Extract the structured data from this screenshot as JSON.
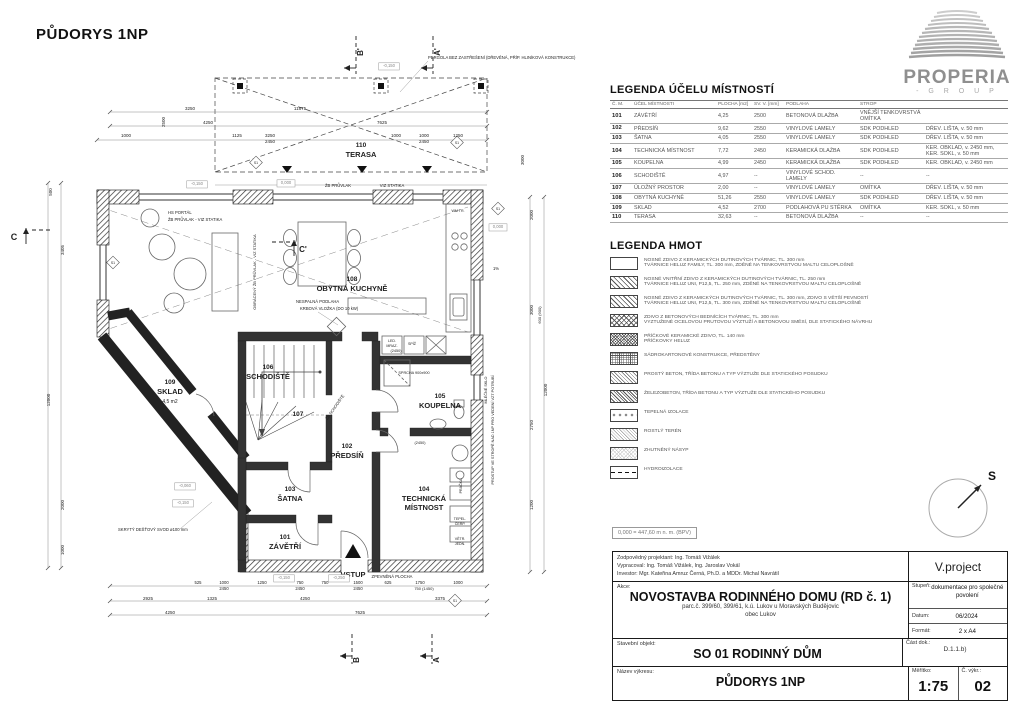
{
  "plan": {
    "title": "PŮDORYS 1NP",
    "texts": [
      {
        "t": "110",
        "x": 361,
        "y": 147,
        "s": 6.5,
        "b": 1,
        "n": "room-number-110"
      },
      {
        "t": "TERASA",
        "x": 361,
        "y": 157,
        "s": 7.5,
        "b": 1,
        "n": "room-label-terasa"
      },
      {
        "t": "108",
        "x": 352,
        "y": 281,
        "s": 6.5,
        "b": 1,
        "n": "room-number-108"
      },
      {
        "t": "OBYTNÁ KUCHYNĚ",
        "x": 352,
        "y": 291,
        "s": 7.5,
        "b": 1,
        "n": "room-label-obytna-kuchyne"
      },
      {
        "t": "109",
        "x": 170,
        "y": 384,
        "s": 6.5,
        "b": 1,
        "n": "room-number-109"
      },
      {
        "t": "SKLAD",
        "x": 170,
        "y": 394,
        "s": 7.5,
        "b": 1,
        "n": "room-label-sklad"
      },
      {
        "t": "4,5 m2",
        "x": 170,
        "y": 403,
        "s": 5,
        "n": "room-area-sklad"
      },
      {
        "t": "106",
        "x": 268,
        "y": 369,
        "s": 6.5,
        "b": 1,
        "n": "room-number-106"
      },
      {
        "t": "SCHODIŠTĚ",
        "x": 268,
        "y": 379,
        "s": 7.5,
        "b": 1,
        "n": "room-label-schodiste"
      },
      {
        "t": "107",
        "x": 298,
        "y": 416,
        "s": 6.5,
        "b": 1,
        "n": "room-number-107"
      },
      {
        "t": "102",
        "x": 347,
        "y": 448,
        "s": 6.5,
        "b": 1,
        "n": "room-number-102"
      },
      {
        "t": "PŘEDSÍŇ",
        "x": 347,
        "y": 458,
        "s": 7.5,
        "b": 1,
        "n": "room-label-predsin"
      },
      {
        "t": "103",
        "x": 290,
        "y": 491,
        "s": 6.5,
        "b": 1,
        "n": "room-number-103"
      },
      {
        "t": "ŠATNA",
        "x": 290,
        "y": 501,
        "s": 7.5,
        "b": 1,
        "n": "room-label-satna"
      },
      {
        "t": "101",
        "x": 285,
        "y": 539,
        "s": 6.5,
        "b": 1,
        "n": "room-number-101"
      },
      {
        "t": "ZÁVĚTŘÍ",
        "x": 285,
        "y": 549,
        "s": 7.5,
        "b": 1,
        "n": "room-label-zavetri"
      },
      {
        "t": "VSTUP",
        "x": 353,
        "y": 577,
        "s": 7.5,
        "b": 1,
        "n": "entrance-label"
      },
      {
        "t": "104",
        "x": 424,
        "y": 491,
        "s": 6.5,
        "b": 1,
        "n": "room-number-104"
      },
      {
        "t": "TECHNICKÁ",
        "x": 424,
        "y": 501,
        "s": 7.5,
        "b": 1,
        "n": "room-label-technicka"
      },
      {
        "t": "MÍSTNOST",
        "x": 424,
        "y": 510,
        "s": 7.5,
        "b": 1,
        "n": "room-label-mistnost"
      },
      {
        "t": "105",
        "x": 440,
        "y": 398,
        "s": 6.5,
        "b": 1,
        "n": "room-number-105"
      },
      {
        "t": "KOUPELNA",
        "x": 440,
        "y": 408,
        "s": 7.5,
        "b": 1,
        "n": "room-label-koupelna"
      },
      {
        "t": "PERGOLA BEZ ZASTŘEŠENÍ (DŘEVĚNÁ, PŘÍP. HLINÍKOVÁ KONSTRUKCE)",
        "x": 428,
        "y": 59,
        "s": 4.2,
        "a": "start",
        "n": "pergola-note"
      },
      {
        "t": "HS PORTÁL",
        "x": 168,
        "y": 214,
        "s": 4.2,
        "a": "start",
        "n": "note-hs-portal"
      },
      {
        "t": "ŽB PRŮVLAK - VIZ STATIKA",
        "x": 168,
        "y": 221,
        "s": 4.2,
        "a": "start",
        "n": "note-pruvlak"
      },
      {
        "t": "ŽB PRŮVLAK",
        "x": 338,
        "y": 187,
        "s": 4.2,
        "n": "note-pruvlak-2"
      },
      {
        "t": "VIZ STATIKA",
        "x": 392,
        "y": 187,
        "s": 4.2,
        "n": "note-viz-statika"
      },
      {
        "t": "NESPALNÁ PODLAHA",
        "x": 296,
        "y": 303,
        "s": 4.2,
        "a": "start",
        "n": "note-krb-1"
      },
      {
        "t": "KRBOVÁ VLOŽKA (DO 10 kW)",
        "x": 300,
        "y": 310,
        "s": 4.2,
        "a": "start",
        "n": "note-krb-2"
      },
      {
        "t": "OBRÁCENÝ ŽB PRŮVLAK - VIZ STATIKA",
        "x": 256,
        "y": 272,
        "s": 4,
        "r": -90,
        "n": "note-obraceny-pruvlak"
      },
      {
        "t": "SPRCHA 900x900",
        "x": 414,
        "y": 374,
        "s": 3.8,
        "n": "note-sprcha"
      },
      {
        "t": "(2450)",
        "x": 396,
        "y": 352,
        "s": 3.8,
        "n": "note-2450-a"
      },
      {
        "t": "(2450)",
        "x": 420,
        "y": 444,
        "s": 3.8,
        "n": "note-2450-b"
      },
      {
        "t": "LED.",
        "x": 392,
        "y": 342,
        "s": 3.6,
        "n": "note-lednice"
      },
      {
        "t": "MRAZ.",
        "x": 392,
        "y": 347,
        "s": 3.6,
        "n": "note-mraznicka"
      },
      {
        "t": "SPÍŽ",
        "x": 412,
        "y": 345,
        "s": 3.6,
        "n": "note-spiz"
      },
      {
        "t": "WM TR.",
        "x": 458,
        "y": 212,
        "s": 3.6,
        "n": "note-wm"
      },
      {
        "t": "SKRYTÝ DEŠŤOVÝ SVOD ø100 mm",
        "x": 118,
        "y": 531,
        "s": 4.2,
        "a": "start",
        "n": "note-svod"
      },
      {
        "t": "ZPEVNĚNÁ PLOCHA",
        "x": 392,
        "y": 578,
        "s": 4.2,
        "n": "note-zpevnena-plocha"
      },
      {
        "t": "PROSTUP VE STROPĚ NAD 1NP PRO VEDENÍ VZT POTRUBÍ",
        "x": 494,
        "y": 430,
        "s": 3.8,
        "r": -90,
        "n": "note-prostup"
      },
      {
        "t": "MLÉČNÉ SKLO",
        "x": 487,
        "y": 390,
        "s": 3.8,
        "r": -90,
        "n": "note-mlecne-sklo"
      },
      {
        "t": "ŽB SCHODIŠTĚ",
        "x": 336,
        "y": 408,
        "s": 4,
        "r": -55,
        "n": "note-zb-schodiste"
      },
      {
        "t": "PRAČKA",
        "x": 462,
        "y": 486,
        "s": 3.6,
        "r": -90,
        "n": "note-pracka"
      },
      {
        "t": "TEPEL.",
        "x": 460,
        "y": 520,
        "s": 3.6,
        "n": "note-tepel"
      },
      {
        "t": "ČERP.",
        "x": 460,
        "y": 525,
        "s": 3.6,
        "n": "note-cerp"
      },
      {
        "t": "VĚTR.",
        "x": 460,
        "y": 540,
        "s": 3.6,
        "n": "note-vetr"
      },
      {
        "t": "JEDN.",
        "x": 460,
        "y": 545,
        "s": 3.6,
        "n": "note-jedn"
      },
      {
        "t": "C",
        "x": 14,
        "y": 240,
        "s": 9,
        "b": 1,
        "n": "section-c"
      },
      {
        "t": "C'",
        "x": 303,
        "y": 252,
        "s": 8,
        "b": 1,
        "n": "section-c-prime"
      },
      {
        "t": "B'",
        "x": 363,
        "y": 52,
        "s": 8,
        "b": 1,
        "r": -90,
        "n": "section-b-prime"
      },
      {
        "t": "A'",
        "x": 440,
        "y": 52,
        "s": 8,
        "b": 1,
        "r": -90,
        "n": "section-a-prime"
      },
      {
        "t": "B",
        "x": 359,
        "y": 660,
        "s": 8,
        "b": 1,
        "r": -90,
        "n": "section-b"
      },
      {
        "t": "A",
        "x": 439,
        "y": 660,
        "s": 8,
        "b": 1,
        "r": -90,
        "n": "section-a"
      },
      {
        "t": "S1",
        "x": 113,
        "y": 264,
        "s": 3.4,
        "n": "mark-s1"
      },
      {
        "t": "S1",
        "x": 256,
        "y": 164,
        "s": 3.4,
        "n": "mark-s1"
      },
      {
        "t": "S1",
        "x": 457,
        "y": 144,
        "s": 3.4,
        "n": "mark-s1"
      },
      {
        "t": "S1",
        "x": 498,
        "y": 210,
        "s": 3.4,
        "n": "mark-s1"
      },
      {
        "t": "S1",
        "x": 455,
        "y": 602,
        "s": 3.4,
        "n": "mark-s1"
      },
      {
        "t": "1%",
        "x": 496,
        "y": 270,
        "s": 4.2,
        "n": "slope-label"
      },
      {
        "t": "1%",
        "x": 283,
        "y": 186,
        "s": 4,
        "n": "slope-label"
      },
      {
        "t": "3250",
        "x": 190,
        "y": 110,
        "s": 4.5,
        "n": "dim"
      },
      {
        "t": "11875",
        "x": 300,
        "y": 110,
        "s": 4.5,
        "n": "dim"
      },
      {
        "t": "4250",
        "x": 208,
        "y": 124,
        "s": 4.5,
        "n": "dim"
      },
      {
        "t": "7625",
        "x": 382,
        "y": 124,
        "s": 4.5,
        "n": "dim"
      },
      {
        "t": "2500",
        "x": 165,
        "y": 122,
        "s": 4.5,
        "r": -90,
        "n": "dim"
      },
      {
        "t": "3000",
        "x": 524,
        "y": 160,
        "s": 4.5,
        "r": -90,
        "n": "dim"
      },
      {
        "t": "1000",
        "x": 126,
        "y": 137,
        "s": 4.5,
        "n": "dim"
      },
      {
        "t": "1125",
        "x": 237,
        "y": 137,
        "s": 4.5,
        "n": "dim"
      },
      {
        "t": "3250",
        "x": 270,
        "y": 137,
        "s": 4.5,
        "n": "dim"
      },
      {
        "t": "2450",
        "x": 270,
        "y": 143,
        "s": 4.5,
        "n": "dim"
      },
      {
        "t": "1000",
        "x": 396,
        "y": 137,
        "s": 4.5,
        "n": "dim"
      },
      {
        "t": "1000",
        "x": 424,
        "y": 137,
        "s": 4.5,
        "n": "dim"
      },
      {
        "t": "2450",
        "x": 424,
        "y": 143,
        "s": 4.5,
        "n": "dim"
      },
      {
        "t": "1250",
        "x": 458,
        "y": 137,
        "s": 4.5,
        "n": "dim"
      },
      {
        "t": "500",
        "x": 52,
        "y": 192,
        "s": 4.5,
        "r": -90,
        "n": "dim"
      },
      {
        "t": "3405",
        "x": 64,
        "y": 250,
        "s": 4.5,
        "r": -90,
        "n": "dim"
      },
      {
        "t": "12000",
        "x": 50,
        "y": 400,
        "s": 4.5,
        "r": -90,
        "n": "dim"
      },
      {
        "t": "2000",
        "x": 64,
        "y": 505,
        "s": 4.5,
        "r": -90,
        "n": "dim"
      },
      {
        "t": "1000",
        "x": 64,
        "y": 550,
        "s": 4.5,
        "r": -90,
        "n": "dim"
      },
      {
        "t": "2000",
        "x": 533,
        "y": 215,
        "s": 4.5,
        "r": -90,
        "n": "dim"
      },
      {
        "t": "3000",
        "x": 533,
        "y": 310,
        "s": 4.5,
        "r": -90,
        "n": "dim"
      },
      {
        "t": "600 (900)",
        "x": 541,
        "y": 315,
        "s": 4,
        "r": -90,
        "n": "dim"
      },
      {
        "t": "2750",
        "x": 533,
        "y": 425,
        "s": 4.5,
        "r": -90,
        "n": "dim"
      },
      {
        "t": "1200",
        "x": 533,
        "y": 505,
        "s": 4.5,
        "r": -90,
        "n": "dim"
      },
      {
        "t": "12000",
        "x": 547,
        "y": 390,
        "s": 4.5,
        "r": -90,
        "n": "dim"
      },
      {
        "t": "525",
        "x": 198,
        "y": 584,
        "s": 4.2,
        "n": "dim"
      },
      {
        "t": "1000",
        "x": 224,
        "y": 584,
        "s": 4.2,
        "n": "dim"
      },
      {
        "t": "2450",
        "x": 224,
        "y": 590,
        "s": 4.2,
        "n": "dim"
      },
      {
        "t": "1250",
        "x": 262,
        "y": 584,
        "s": 4.2,
        "n": "dim"
      },
      {
        "t": "750",
        "x": 300,
        "y": 584,
        "s": 4.2,
        "n": "dim"
      },
      {
        "t": "2450",
        "x": 300,
        "y": 590,
        "s": 4.2,
        "n": "dim"
      },
      {
        "t": "750",
        "x": 325,
        "y": 584,
        "s": 4.2,
        "n": "dim"
      },
      {
        "t": "1500",
        "x": 358,
        "y": 584,
        "s": 4.2,
        "n": "dim"
      },
      {
        "t": "2450",
        "x": 358,
        "y": 590,
        "s": 4.2,
        "n": "dim"
      },
      {
        "t": "625",
        "x": 388,
        "y": 584,
        "s": 4.2,
        "n": "dim"
      },
      {
        "t": "1750",
        "x": 420,
        "y": 584,
        "s": 4.2,
        "n": "dim"
      },
      {
        "t": "750 (1450)",
        "x": 424,
        "y": 590,
        "s": 4,
        "n": "dim"
      },
      {
        "t": "1000",
        "x": 458,
        "y": 584,
        "s": 4.2,
        "n": "dim"
      },
      {
        "t": "2925",
        "x": 148,
        "y": 600,
        "s": 4.5,
        "n": "dim"
      },
      {
        "t": "1325",
        "x": 212,
        "y": 600,
        "s": 4.5,
        "n": "dim"
      },
      {
        "t": "4250",
        "x": 305,
        "y": 600,
        "s": 4.5,
        "n": "dim"
      },
      {
        "t": "3375",
        "x": 440,
        "y": 600,
        "s": 4.5,
        "n": "dim"
      },
      {
        "t": "4250",
        "x": 170,
        "y": 614,
        "s": 4.5,
        "n": "dim"
      },
      {
        "t": "7625",
        "x": 360,
        "y": 614,
        "s": 4.5,
        "n": "dim"
      },
      {
        "t": "-0,150",
        "x": 197,
        "y": 185,
        "s": 4.2,
        "boxed": 1,
        "c": "#888",
        "n": "level-marker"
      },
      {
        "t": "0,000",
        "x": 286,
        "y": 184,
        "s": 4.2,
        "boxed": 1,
        "c": "#888",
        "n": "level-marker"
      },
      {
        "t": "-0,150",
        "x": 389,
        "y": 67,
        "s": 4.2,
        "boxed": 1,
        "c": "#888",
        "n": "level-marker"
      },
      {
        "t": "0,000",
        "x": 498,
        "y": 228,
        "s": 4.2,
        "boxed": 1,
        "c": "#888",
        "n": "level-marker"
      },
      {
        "t": "-0,150",
        "x": 284,
        "y": 579,
        "s": 4.2,
        "boxed": 1,
        "c": "#888",
        "n": "level-marker"
      },
      {
        "t": "-0,250",
        "x": 339,
        "y": 579,
        "s": 4.2,
        "boxed": 1,
        "c": "#888",
        "n": "level-marker"
      },
      {
        "t": "-0,060",
        "x": 185,
        "y": 487,
        "s": 4.2,
        "boxed": 1,
        "c": "#888",
        "n": "level-marker"
      },
      {
        "t": "-0,150",
        "x": 183,
        "y": 504,
        "s": 4.2,
        "boxed": 1,
        "c": "#888",
        "n": "level-marker"
      }
    ]
  },
  "logo": {
    "name": "PROPERIA",
    "sub": "- G R O U P"
  },
  "north": {
    "label": "S"
  },
  "level_note": "0,000 = 447,60 m n. m. (BPV)",
  "legend_rooms": {
    "title": "LEGENDA ÚČELU MÍSTNOSTÍ",
    "headers": [
      "Č. M.",
      "ÚČEL MÍSTNOSTI",
      "PLOCHA [m2]",
      "SV. V. [mm]",
      "PODLAHA",
      "STROP",
      ""
    ],
    "rows": [
      [
        "101",
        "ZÁVĚTŘÍ",
        "4,25",
        "2500",
        "BETONOVÁ DLAŽBA",
        "VNĚJŠÍ TENKOVRSTVÁ OMÍTKA",
        ""
      ],
      [
        "102",
        "PŘEDSÍŇ",
        "9,62",
        "2550",
        "VINYLOVÉ LAMELY",
        "SDK PODHLED",
        "DŘEV. LIŠTA, v. 50 mm"
      ],
      [
        "103",
        "ŠATNA",
        "4,05",
        "2550",
        "VINYLOVÉ LAMELY",
        "SDK PODHLED",
        "DŘEV. LIŠTA, v. 50 mm"
      ],
      [
        "104",
        "TECHNICKÁ MÍSTNOST",
        "7,72",
        "2450",
        "KERAMICKÁ DLAŽBA",
        "SDK PODHLED",
        "KER. OBKLAD, v. 2450 mm, KER. SOKL, v. 50 mm"
      ],
      [
        "105",
        "KOUPELNA",
        "4,99",
        "2450",
        "KERAMICKÁ DLAŽBA",
        "SDK PODHLED",
        "KER. OBKLAD, v. 2450 mm"
      ],
      [
        "106",
        "SCHODIŠTĚ",
        "4,97",
        "--",
        "VINYLOVÉ SCHOD. LAMELY",
        "--",
        "--"
      ],
      [
        "107",
        "ÚLOŽNÝ PROSTOR",
        "2,00",
        "--",
        "VINYLOVÉ LAMELY",
        "OMÍTKA",
        "DŘEV. LIŠTA, v. 50 mm"
      ],
      [
        "108",
        "OBYTNÁ KUCHYNĚ",
        "51,26",
        "2550",
        "VINYLOVÉ LAMELY",
        "SDK PODHLED",
        "DŘEV. LIŠTA, v. 50 mm"
      ],
      [
        "109",
        "SKLAD",
        "4,52",
        "2700",
        "PODLAHOVÁ PU STĚRKA",
        "OMÍTKA",
        "KER. SOKL, v. 50 mm"
      ],
      [
        "110",
        "TERASA",
        "32,63",
        "--",
        "BETONOVÁ DLAŽBA",
        "--",
        "--"
      ]
    ]
  },
  "legend_hmot": {
    "title": "LEGENDA HMOT",
    "items": [
      {
        "pat": "pat-empty",
        "lines": [
          "NOSNÉ ZDIVO Z KERAMICKÝCH DUTINOVÝCH TVÁRNIC, TL. 300 mm",
          "TVÁRNICE HELUZ FAMILY, TL. 300 mm, ZDĚNÉ NA TENKOVRSTVOU MALTU CELOPLOŠNĚ"
        ]
      },
      {
        "pat": "pat-diag",
        "lines": [
          "NOSNÉ VNITŘNÍ ZDIVO Z KERAMICKÝCH DUTINOVÝCH TVÁRNIC, TL. 250 mm",
          "TVÁRNICE HELUZ UNI, P12,5, TL. 250 mm, ZDĚNÉ NA TENKOVRSTVOU MALTU CELOPLOŠNĚ"
        ]
      },
      {
        "pat": "pat-diag",
        "lines": [
          "NOSNÉ ZDIVO Z KERAMICKÝCH DUTINOVÝCH TVÁRNIC, TL. 300 mm, ZDIVO S VĚTŠÍ PEVNOSTÍ",
          "TVÁRNICE HELUZ UNI, P12,5, TL. 300 mm, ZDĚNÉ NA TENKOVRSTVOU MALTU CELOPLOŠNĚ"
        ]
      },
      {
        "pat": "pat-cross",
        "lines": [
          "ZDIVO Z BETONOVÝCH BEDNÍCÍCH TVÁRNIC, TL. 300 mm",
          "VYZTUŽENÉ OCELOVOU PRUTOVOU VÝZTUŽÍ A BETONOVOU SMĚSÍ, DLE STATICKÉHO NÁVRHU"
        ]
      },
      {
        "pat": "pat-diamond",
        "lines": [
          "PŘÍČKOVÉ KERAMICKÉ ZDIVO, TL. 140 mm",
          "PŘÍČKOVKY HELUZ"
        ]
      },
      {
        "pat": "pat-grid",
        "lines": [
          "SÁDROKARTONOVÉ KONSTRUKCE, PŘEDSTĚNY"
        ]
      },
      {
        "pat": "pat-diagfine",
        "lines": [
          "PROSTÝ BETON, TŘÍDA BETONU A TYP VÝZTUŽE DLE STATICKÉHO POSUDKU"
        ]
      },
      {
        "pat": "pat-rc",
        "lines": [
          "ŽELEZOBETON, TŘÍDA BETONU A TYP VÝZTUŽE DLE STATICKÉHO POSUDKU"
        ]
      },
      {
        "pat": "pat-insul",
        "lines": [
          "TEPELNÁ IZOLACE"
        ]
      },
      {
        "pat": "pat-teren",
        "lines": [
          "ROSTLÝ TERÉN"
        ]
      },
      {
        "pat": "pat-nasyp",
        "lines": [
          "ZHUTNĚNÝ NÁSYP"
        ]
      },
      {
        "pat": "pat-hydro",
        "lines": [
          "HYDROIZOLACE"
        ]
      }
    ]
  },
  "title_block": {
    "responsible": "Zodpovědný projektant: Ing. Tomáš Vižálek",
    "prepared": "Vypracoval: Ing. Tomáš Vižálek, Ing. Jaroslav Vokál",
    "investor": "Investor: Mgr. Kateřina Amruz Černá, Ph.D. a MDDr. Michal Navrátil",
    "company": "V.project",
    "akce_label": "Akce:",
    "project_title": "NOVOSTAVBA RODINNÉHO DOMU (RD č. 1)",
    "project_sub1": "parc.č. 399/60, 399/61, k.ú. Lukov u Moravských Budějovic",
    "project_sub2": "obec Lukov",
    "stupen_label": "Stupeň:",
    "stupen": "dokumentace pro společné povolení",
    "datum_label": "Datum:",
    "datum": "06/2024",
    "format_label": "Formát:",
    "format": "2 x A4",
    "object_label": "Stavební objekt:",
    "object": "SO 01 RODINNÝ DŮM",
    "cast_label": "Část dok.:",
    "cast": "D.1.1.b)",
    "drawing_label": "Název výkresu:",
    "drawing": "PŮDORYS 1NP",
    "scale_label": "Měřítko:",
    "scale": "1:75",
    "number_label": "Č. výkr.:",
    "number": "02"
  }
}
